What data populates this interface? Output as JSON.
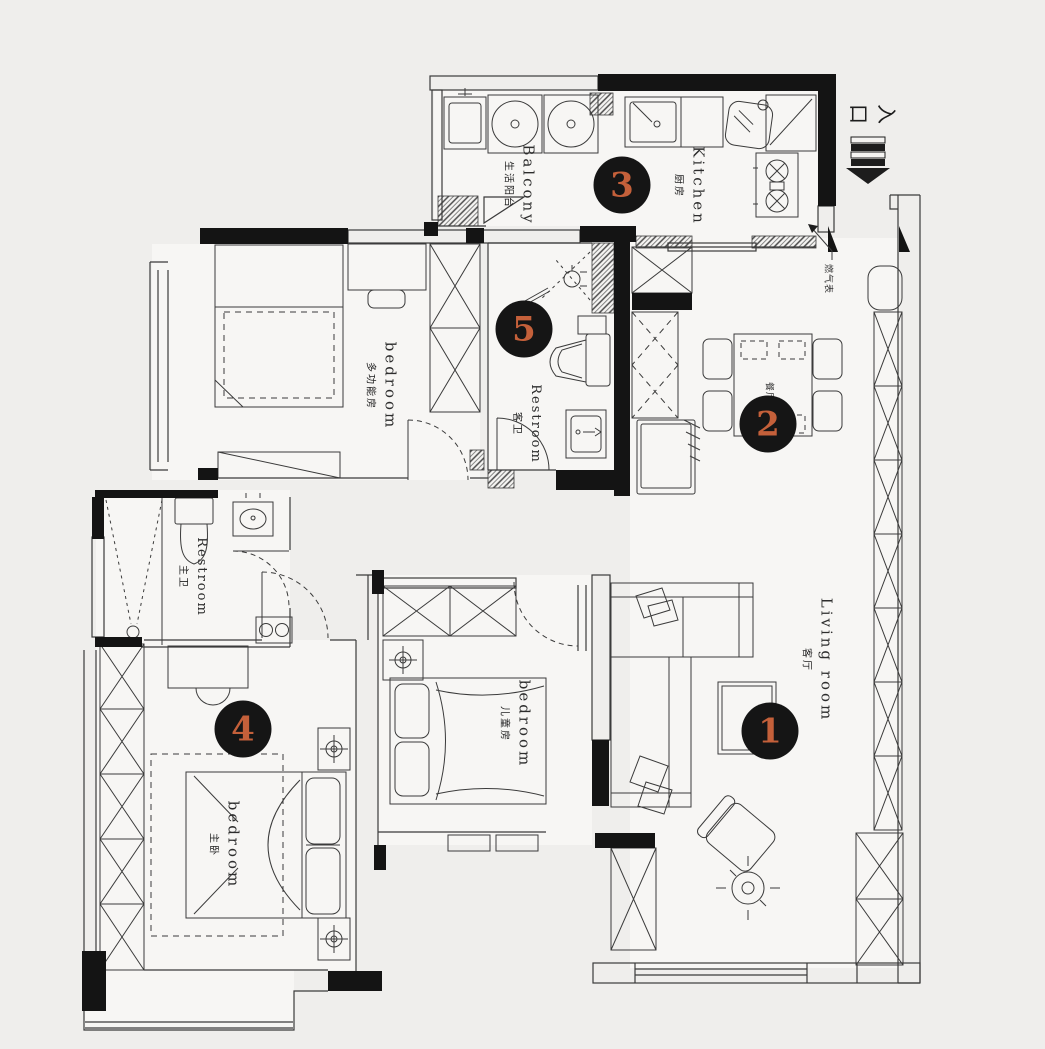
{
  "palette": {
    "background": "#efeeec",
    "line": "#3b3b3b",
    "wall": "#141414",
    "badge_bg": "#151515",
    "badge_number": "#c4603a"
  },
  "badges": [
    {
      "n": "1"
    },
    {
      "n": "2"
    },
    {
      "n": "3"
    },
    {
      "n": "4"
    },
    {
      "n": "5"
    }
  ],
  "rooms": {
    "living_room": {
      "en": "Living room",
      "zh": "客厅"
    },
    "dining": {
      "zh": "餐厅"
    },
    "kitchen": {
      "en": "Kitchen",
      "zh": "厨房"
    },
    "balcony": {
      "en": "Balcony",
      "zh": "生活阳台"
    },
    "bedroom_multi": {
      "en": "bedroom",
      "zh": "多功能房"
    },
    "bedroom_kids": {
      "en": "bedroom",
      "zh": "儿童房"
    },
    "bedroom_master": {
      "en": "bedroom",
      "zh": "主卧"
    },
    "restroom_hall": {
      "en": "Restroom",
      "zh": "客卫"
    },
    "restroom_master": {
      "en": "Restroom",
      "zh": "主卫"
    }
  },
  "annotations": {
    "entrance": "入口",
    "gas_meter": "燃气表"
  },
  "icons": {
    "entrance_arrow": "striped-down-arrow",
    "ceiling_light": "crosshair-circle",
    "wall_light": "target-symbol"
  }
}
